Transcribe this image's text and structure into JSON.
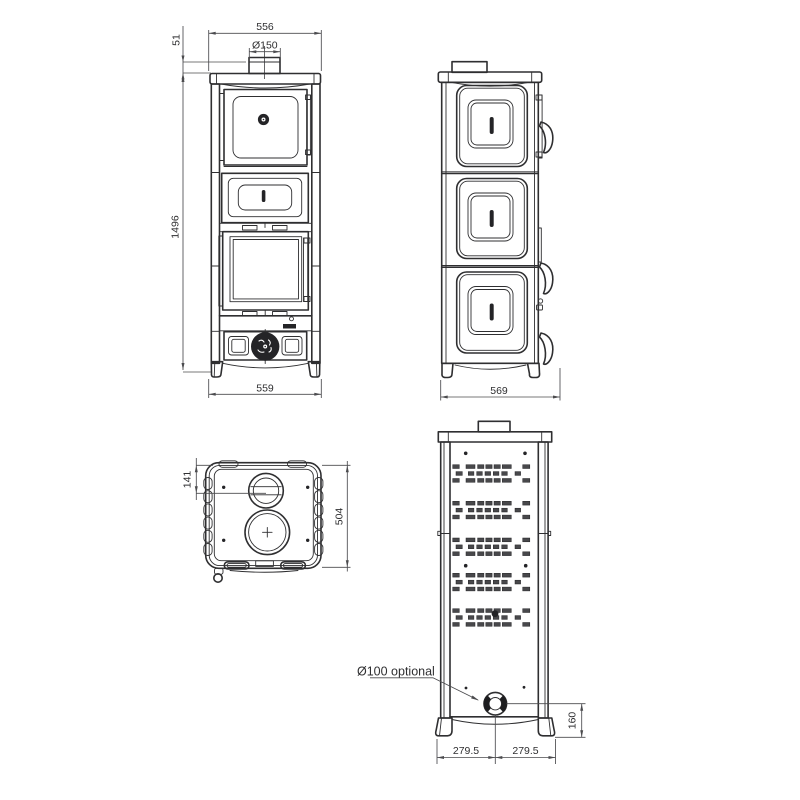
{
  "colors": {
    "line": "#2f2f31",
    "dim": "#4b4b4e",
    "dark_fill": "#242427",
    "background": "#ffffff",
    "text": "#2f2f31"
  },
  "views": {
    "front": {
      "dim_top_width": "556",
      "dim_flue_diameter": "Ø150",
      "dim_collar_height": "51",
      "dim_total_height": "1496",
      "dim_base_width": "559"
    },
    "side": {
      "dim_depth": "569"
    },
    "top": {
      "dim_flue_center_offset": "141",
      "dim_body_depth": "504"
    },
    "rear": {
      "label_rear_flue": "Ø100 optional",
      "dim_flue_axis_height": "160",
      "dim_half_width_left": "279.5",
      "dim_half_width_right": "279.5"
    }
  }
}
